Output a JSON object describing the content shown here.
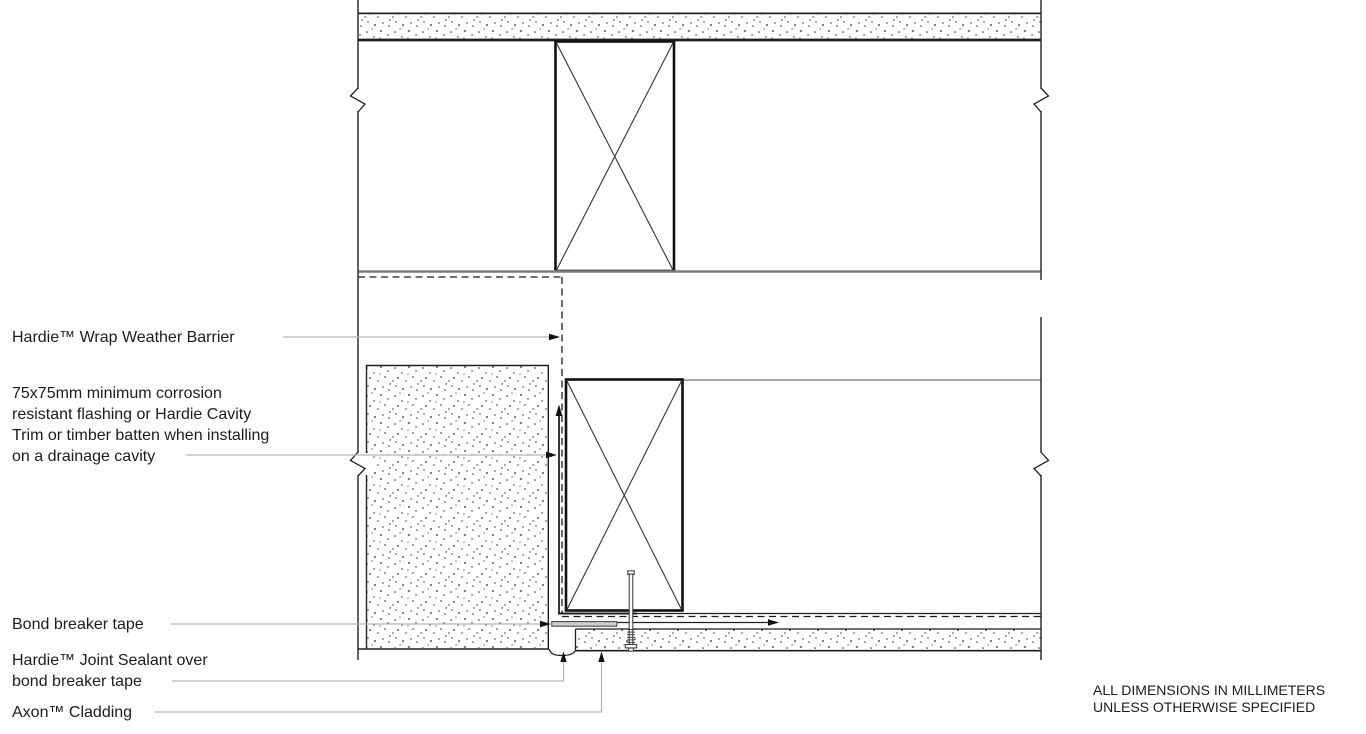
{
  "drawing_title": "Axon cladding joint detail (section)",
  "labels": {
    "weather_barrier": "Hardie™ Wrap Weather Barrier",
    "flashing": "75x75mm minimum corrosion\nresistant flashing or Hardie Cavity\nTrim or timber batten when installing\non a drainage cavity",
    "bond_breaker_tape": "Bond breaker tape",
    "joint_sealant": "Hardie™ Joint Sealant over\nbond breaker tape",
    "axon_cladding": "Axon™ Cladding"
  },
  "notes": {
    "dimensions": "ALL DIMENSIONS IN MILLIMETERS\nUNLESS OTHERWISE SPECIFIED"
  },
  "colors": {
    "background": "#ffffff",
    "line": "#1f1f1f",
    "gray_line": "#7d7d7d",
    "leader_line": "#b3b3b3",
    "tape_fill": "#cfcfcf"
  }
}
